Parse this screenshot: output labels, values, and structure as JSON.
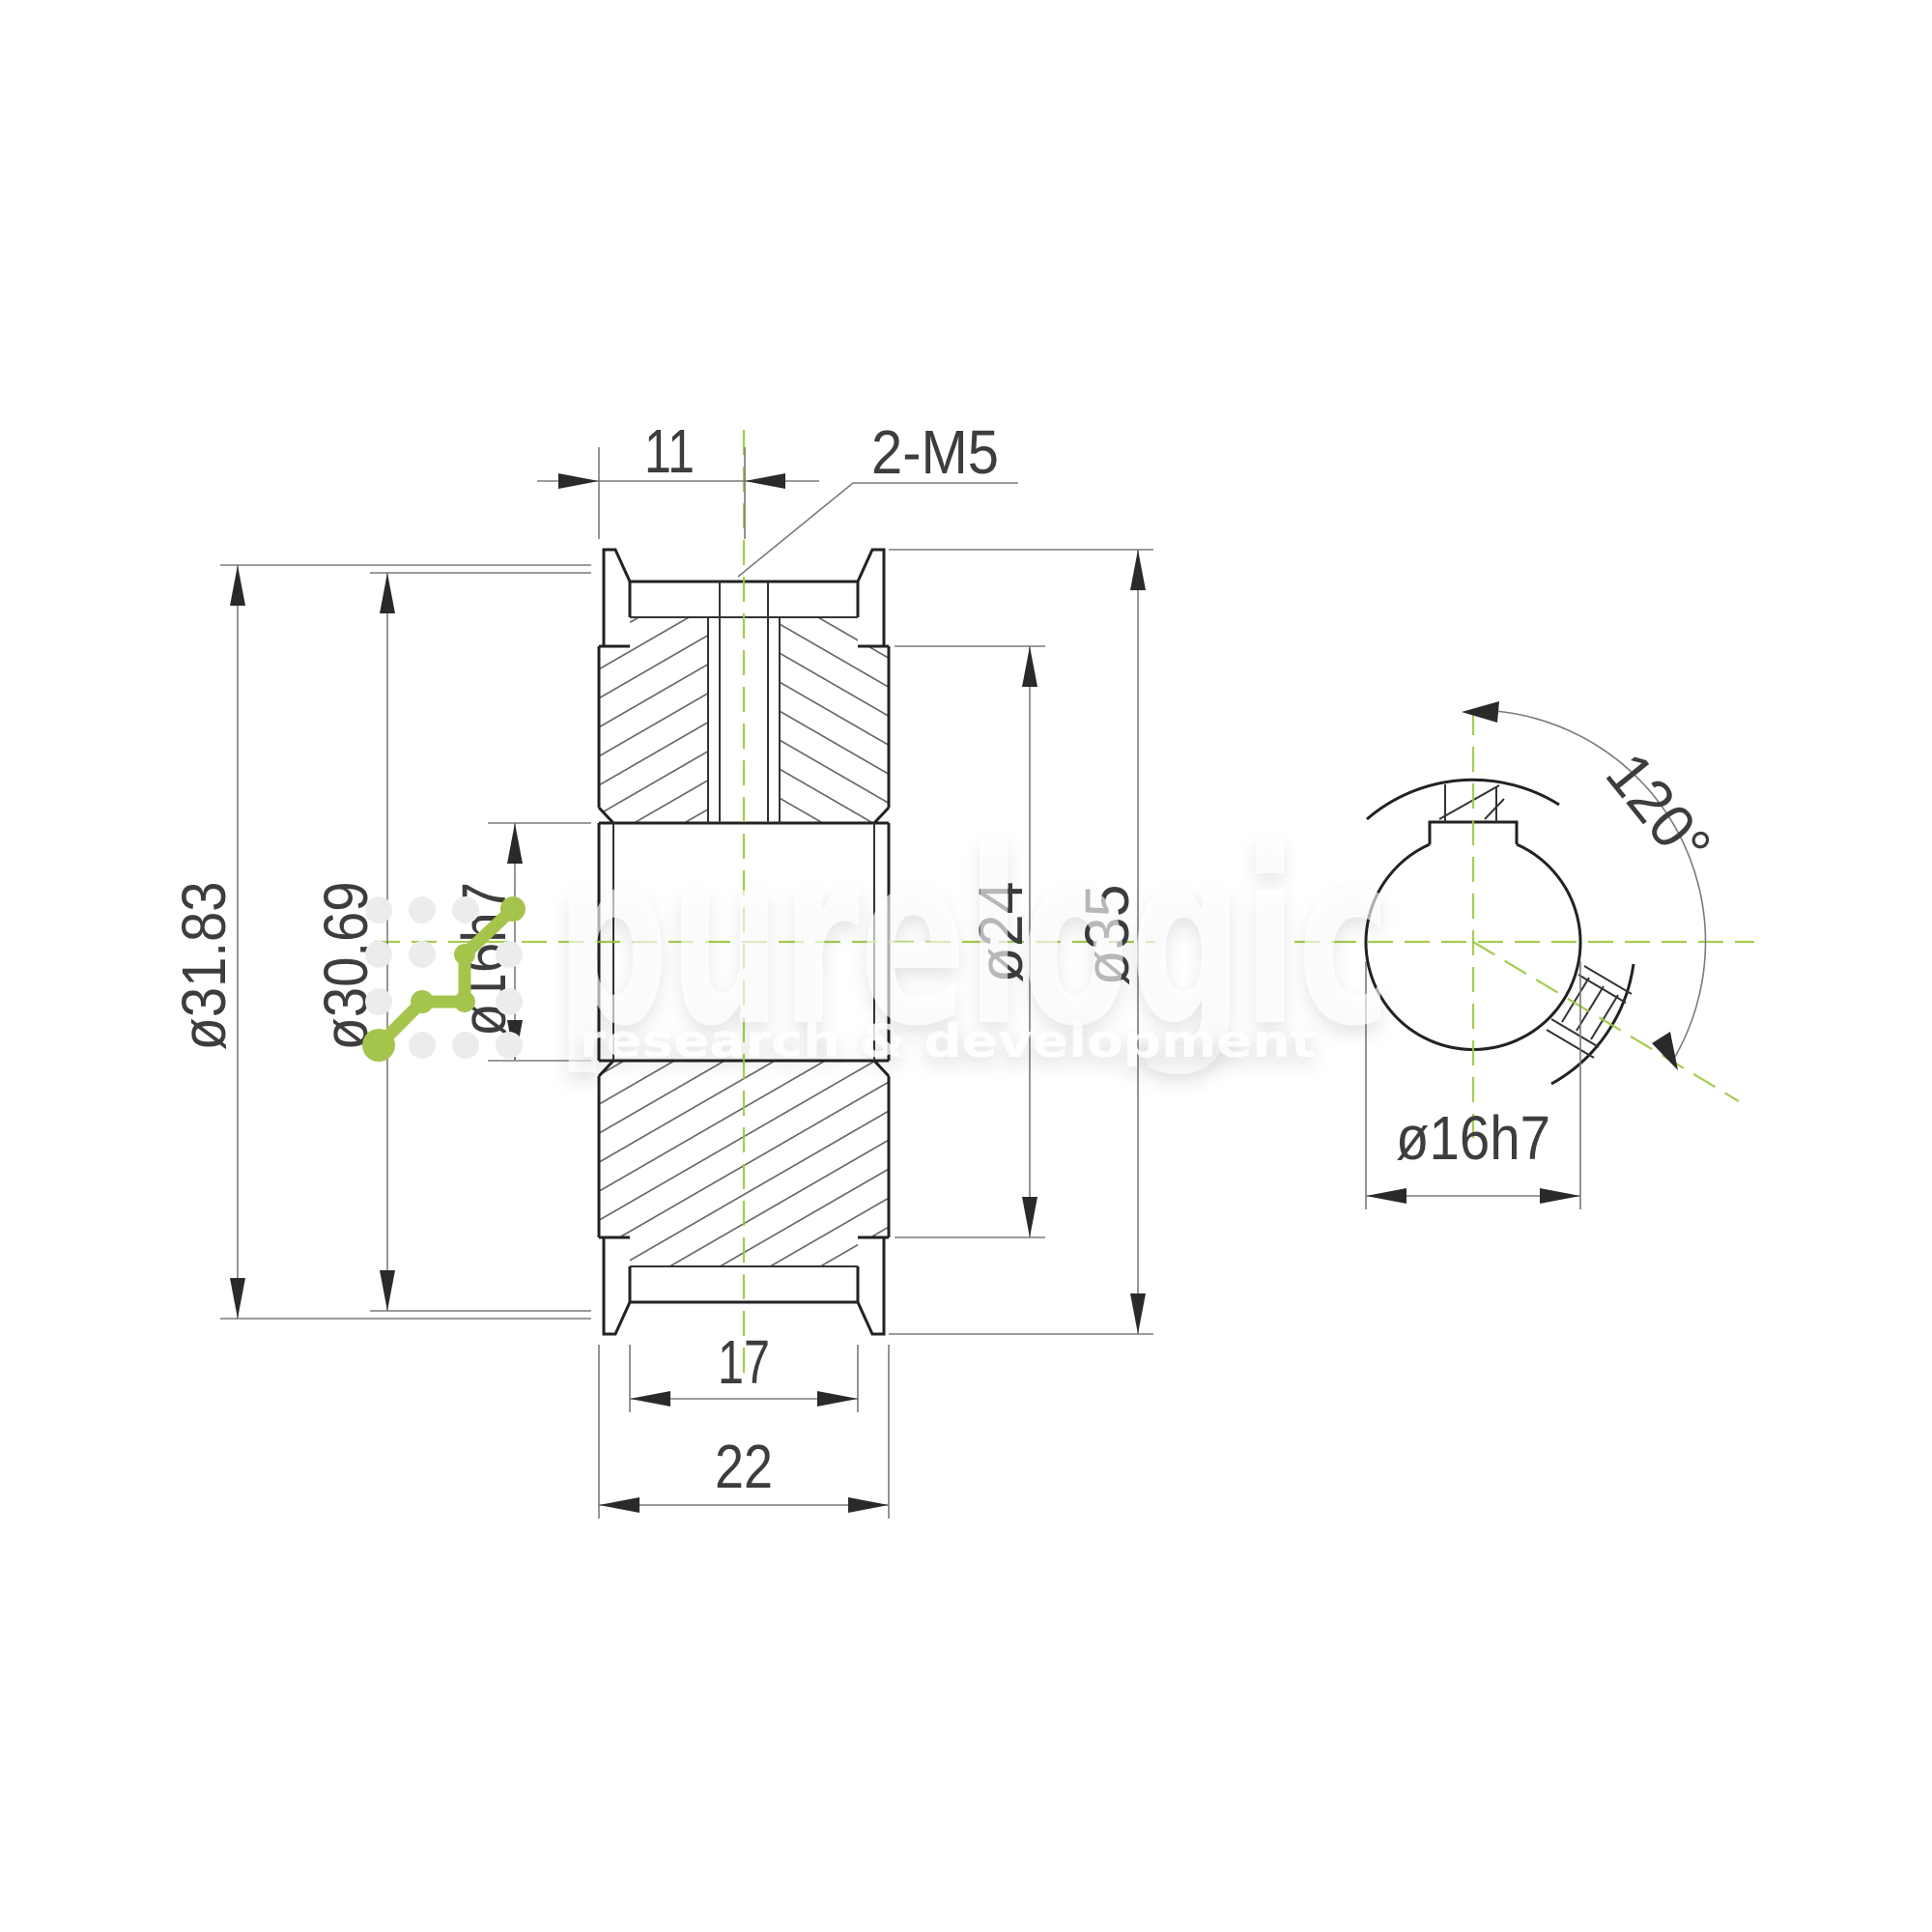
{
  "drawing_type": "technical-drawing",
  "part": "timing pulley cross-section and side view",
  "front_view": {
    "offset_label": "11",
    "thread_label": "2-M5",
    "pitch_diameter": "ø31.83",
    "outside_diameter": "ø30.69",
    "bore_diameter": "ø16h7",
    "hub_diameter": "ø24",
    "flange_diameter": "ø35",
    "belt_width": "17",
    "overall_width": "22"
  },
  "side_view": {
    "screw_angle": "120°",
    "bore_diameter": "ø16h7"
  },
  "watermark": {
    "brand": "purelogic",
    "tagline": "research & development"
  },
  "colors": {
    "centerline_green": "#9bc83e",
    "logo_green": "#a5c44c",
    "line_dark": "#222222",
    "dim_grey": "#7b7b7b",
    "watermark_white": "#ffffff"
  }
}
